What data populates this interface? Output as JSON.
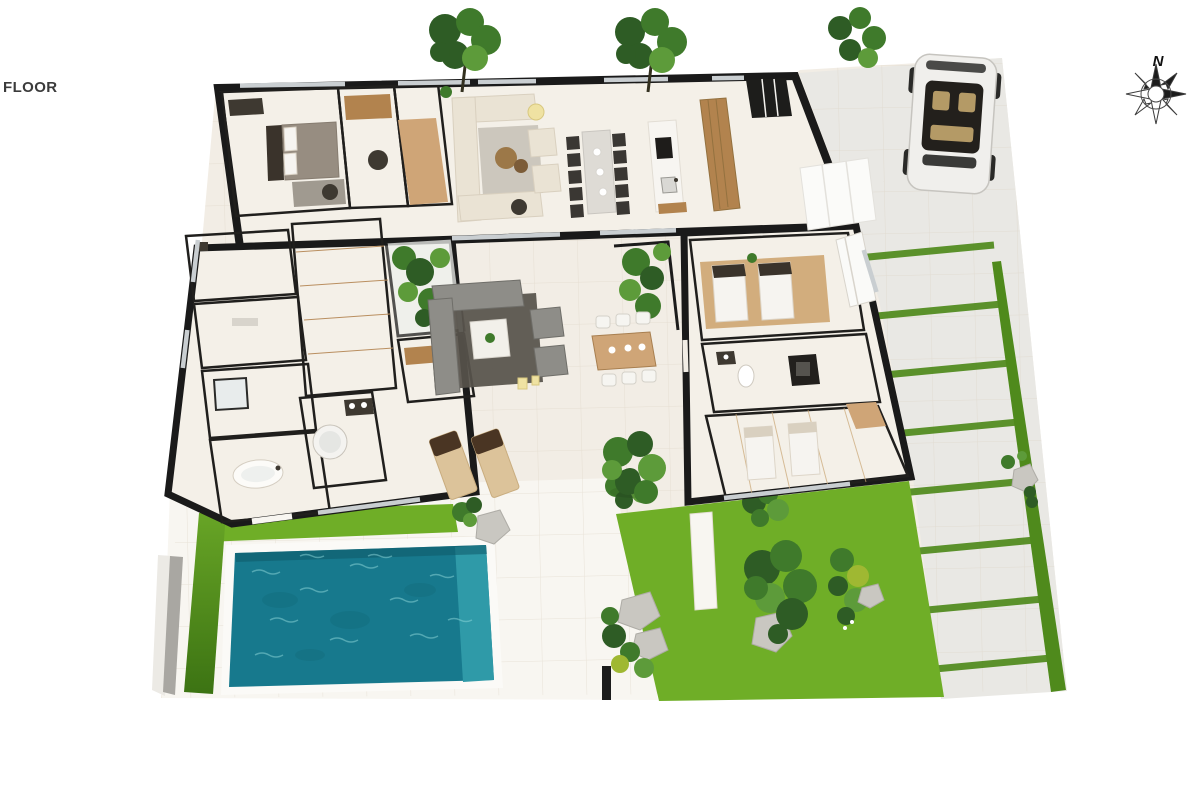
{
  "labels": {
    "floor": "FLOOR",
    "north": "N"
  },
  "palette": {
    "bg": "#ffffff",
    "label_text": "#3b3b3b",
    "wall": "#1a1a1a",
    "terrace": "#f2ede5",
    "deck": "#f8f6f1",
    "driveway": "#e9e8e4",
    "room_floor": "#f4f0e8",
    "room_floor_warm": "#e9dcc8",
    "wood_light": "#d2ad7d",
    "wood_mid": "#cfa577",
    "wood_dark": "#b2834e",
    "grass": "#6fae27",
    "grass_dark": "#4f8a1c",
    "grass_deep": "#3c7313",
    "pool": "#17798d",
    "pool_light": "#2f9aa8",
    "pool_pale": "#55b6bf",
    "ripple": "#8fd8da",
    "rug_gray": "#ccc7bd",
    "rug_dark": "#57534b",
    "rug_taupe": "#a09a90",
    "sofa_cream": "#eae3d4",
    "sofa_gray": "#8e8d88",
    "chair_dark": "#3a3733",
    "marble": "#dedbd5",
    "bed_white": "#f6f4f0",
    "headboard": "#3a332b",
    "glass": "#c9ced1",
    "white": "#fbfaf7",
    "stone": "#c9c7c1",
    "stone_dark": "#aeaca6",
    "tree1": "#2e5c25",
    "tree2": "#3f7a2b",
    "tree3": "#5d9b3a",
    "leaf_yellow": "#9fb832",
    "car_body": "#f0efec",
    "car_glass": "#23201c",
    "car_seat": "#b49a66",
    "lamp": "#efe2a2",
    "dark_fixture": "#3e3931"
  },
  "scene": {
    "type": "3d-floor-plan",
    "features": [
      "villa",
      "swimming-pool",
      "pool-deck-lawn",
      "garden",
      "terrace-patio",
      "driveway",
      "parked-car",
      "stepping-stone-path",
      "compass-rose"
    ],
    "counts": {
      "top_trees": 3,
      "sun_loungers": 2,
      "indoor_dining_chairs": 10,
      "outdoor_dining_chairs": 6,
      "beds": 5,
      "parking_grass_stripes": 8
    }
  }
}
